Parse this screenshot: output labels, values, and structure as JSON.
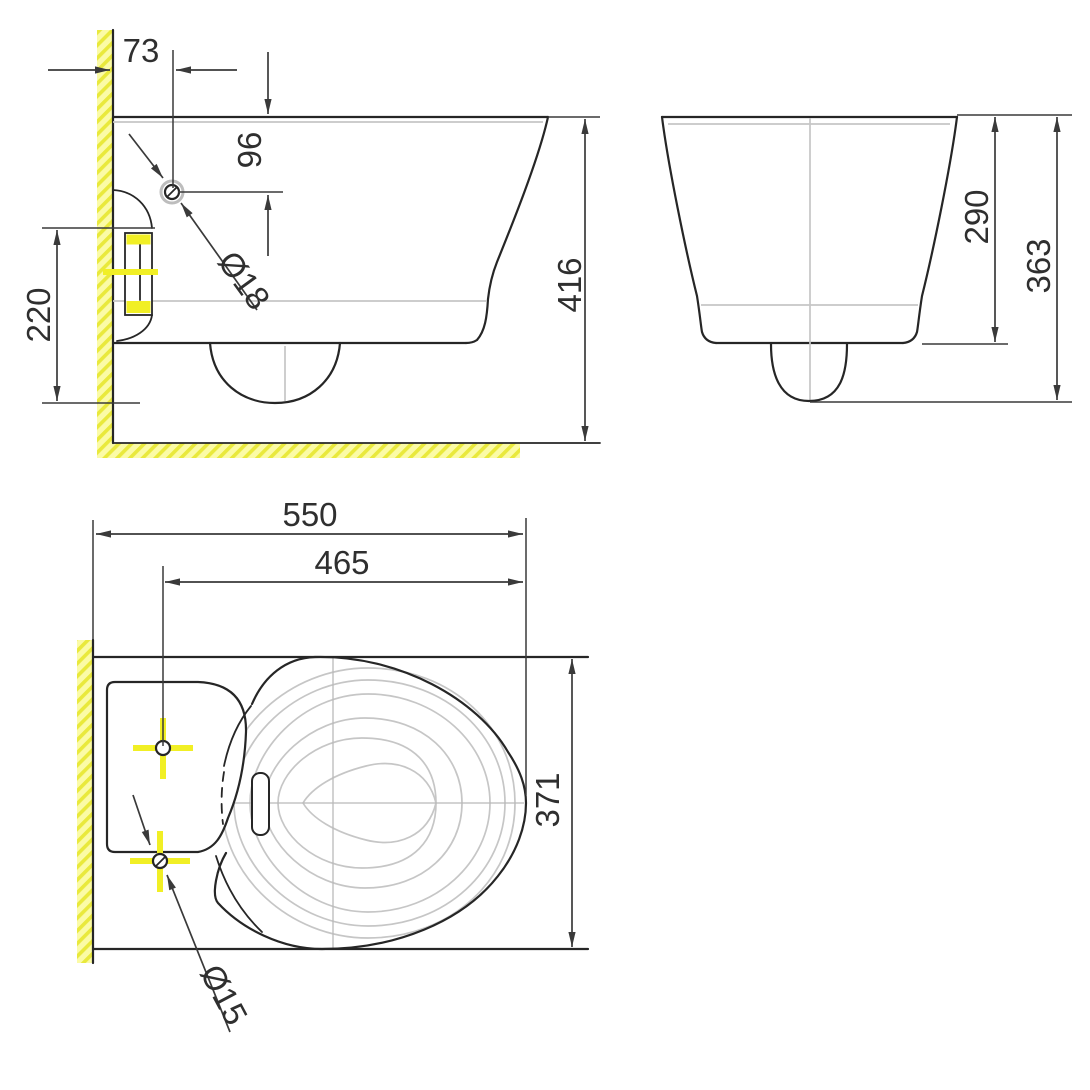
{
  "drawing": {
    "title": "wall-hung toilet installation drawing",
    "views": {
      "side": {
        "label": "side view",
        "dims": {
          "wall_to_hole": "73",
          "rim_to_hole": "96",
          "hole_diameter": "Ø18",
          "bracket_to_trap": "220",
          "rim_to_floor": "416"
        }
      },
      "front": {
        "label": "front view",
        "dims": {
          "body_height": "290",
          "overall_height": "363"
        }
      },
      "plan": {
        "label": "plan view",
        "dims": {
          "overall_depth": "550",
          "hole_to_front": "465",
          "overall_width": "371",
          "hole_diameter": "Ø15"
        }
      }
    },
    "colors": {
      "background": "#ffffff",
      "line": "#262626",
      "dimension_line": "#3a3a3a",
      "light_contour": "#c6c6c6",
      "centerline": "#b9b9b9",
      "highlight_yellow": "#f1ef25",
      "hatch_bg": "#fbfba6",
      "hatch_stripe": "#e9e93c"
    }
  }
}
